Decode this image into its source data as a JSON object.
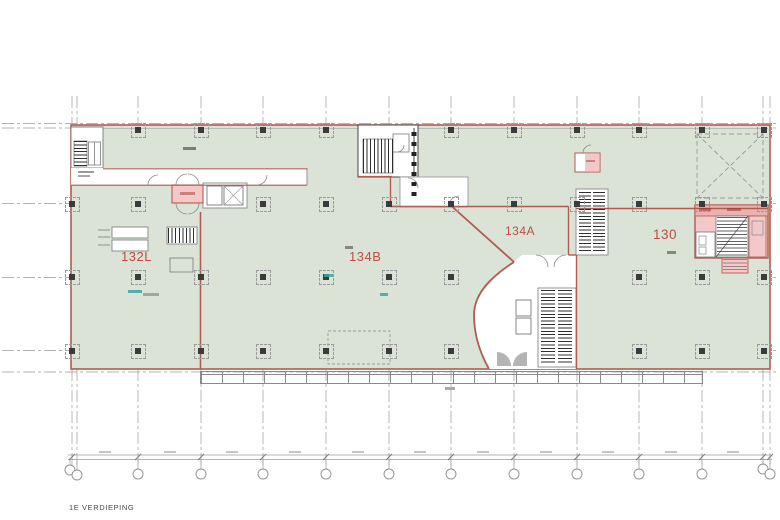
{
  "header": {
    "title": "1E VERDIEPING"
  },
  "rooms": [
    {
      "id": "132L",
      "label": "132L"
    },
    {
      "id": "134B",
      "label": "134B"
    },
    {
      "id": "134A",
      "label": "134A"
    },
    {
      "id": "130",
      "label": "130"
    }
  ],
  "colors": {
    "floor_fill": "#dbe3d6",
    "room_fill": "#f2c9c8",
    "room_fill_dark": "#e9b2b0",
    "boundary_red": "#b25b50",
    "label_red": "#c24b42",
    "grid_gray": "#9a9a9a",
    "hatch_dark": "#2e2e2e",
    "line_gray": "#8a8a8a",
    "teal": "#3aa6a0"
  }
}
